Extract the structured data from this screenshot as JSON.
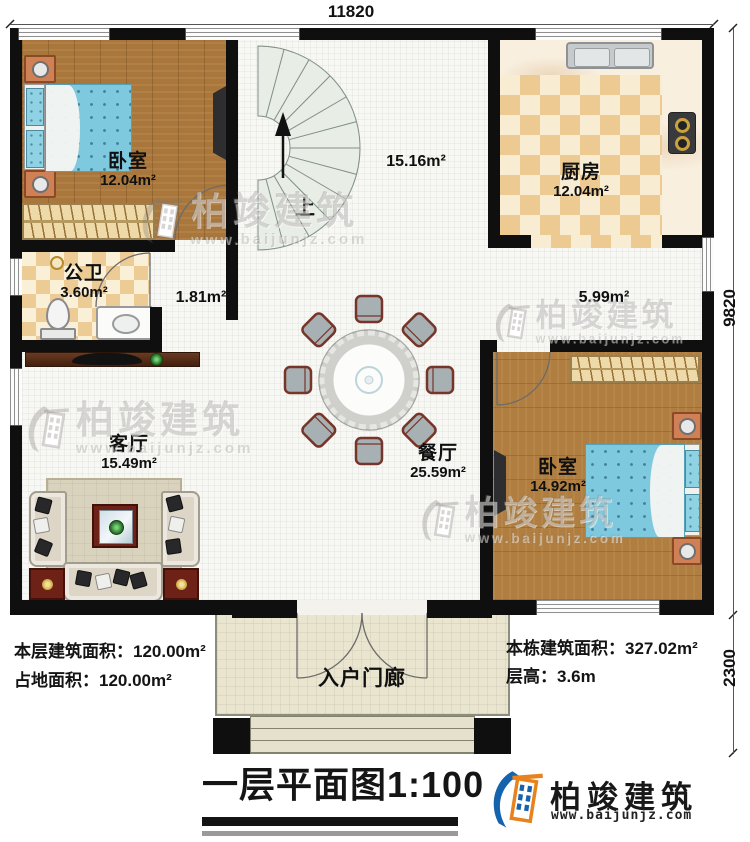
{
  "dimensions": {
    "top": "11820",
    "right": "9820",
    "porch_right": "2300"
  },
  "rooms": {
    "bedroom1": {
      "name": "卧室",
      "area": "12.04m²"
    },
    "kitchen": {
      "name": "厨房",
      "area": "12.04m²"
    },
    "bathroom": {
      "name": "公卫",
      "area": "3.60m²"
    },
    "living": {
      "name": "客厅",
      "area": "15.49m²"
    },
    "dining": {
      "name": "餐厅",
      "area": "25.59m²"
    },
    "bedroom2": {
      "name": "卧室",
      "area": "14.92m²"
    },
    "porch": {
      "name": "入户门廊"
    }
  },
  "open_areas": {
    "stair_hall": "15.16m²",
    "hallway": "1.81m²",
    "corridor": "5.99m²"
  },
  "stairs": {
    "direction": "上"
  },
  "stats": {
    "floor_area_label": "本层建筑面积：",
    "floor_area_value": "120.00m²",
    "footprint_label": "占地面积：",
    "footprint_value": "120.00m²",
    "building_area_label": "本栋建筑面积：",
    "building_area_value": "327.02m²",
    "storey_height_label": "层高：",
    "storey_height_value": "3.6m"
  },
  "title": {
    "name": "一层平面图",
    "scale": "1:100"
  },
  "brand": {
    "name": "柏竣建筑",
    "url": "www.baijunjz.com"
  },
  "watermark": {
    "name": "柏竣建筑",
    "url": "www.baijunjz.com"
  },
  "colors": {
    "wall": "#0f0f0f",
    "wood": "#a9773c",
    "tile": "#ecca92",
    "brand_blue": "#1663ad",
    "brand_orange": "#e8821c"
  }
}
